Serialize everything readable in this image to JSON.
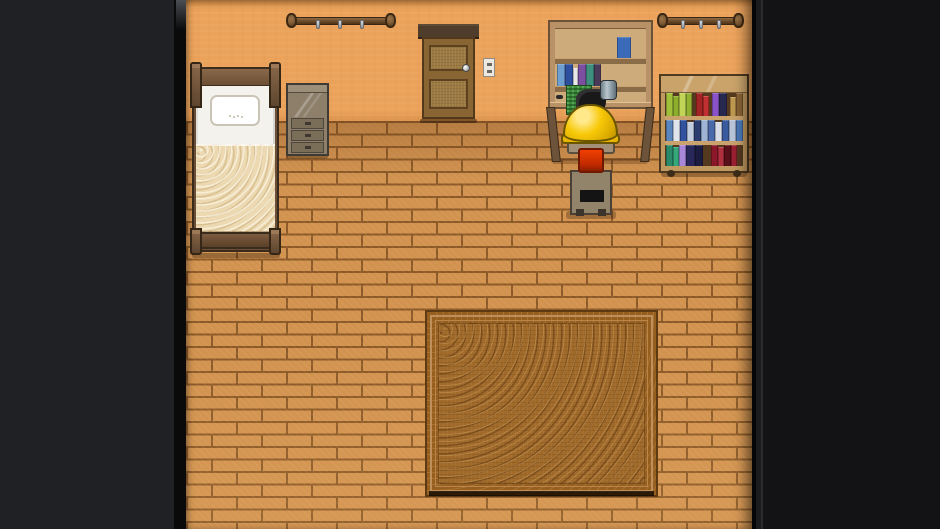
{
  "app": {
    "type": "game-screenshot",
    "scene_name": "pixel-art bedroom interior (top-down RPG room)"
  },
  "scene": {
    "objects": [
      {
        "name": "left-wall-rack"
      },
      {
        "name": "right-wall-rack"
      },
      {
        "name": "wooden-door"
      },
      {
        "name": "light-switch"
      },
      {
        "name": "bed-with-pillow-and-blanket"
      },
      {
        "name": "nightstand-dresser"
      },
      {
        "name": "workbench-desk-with-hutch"
      },
      {
        "name": "machine-with-circuit-board"
      },
      {
        "name": "character-in-yellow-hard-hat"
      },
      {
        "name": "chair"
      },
      {
        "name": "rolling-bookshelf"
      },
      {
        "name": "ornate-rug"
      }
    ]
  },
  "palette": {
    "letterbox_left": "#1f2124",
    "letterbox_divider": "#0a0a0b",
    "letterbox_right": "#131315",
    "wall": "#eba25a",
    "floor_brick": "#d29350",
    "floor_mortar": "#8c5a28",
    "rug_base": "#9c6526",
    "rug_border_line": "#c0905a",
    "bed_frame": "#79593c",
    "bed_sheet": "#f4f2ec",
    "bed_blanket": "#ecd9b2",
    "dresser": "#8d7f6a",
    "door": "#8a6534",
    "desk": "#ceab7a",
    "helmet_yellow": "#f7c908",
    "jacket_patch_orange": "#e83600",
    "chair": "#92836b",
    "bookshelf": "#bf9960",
    "circuit_green": "#3c8a3c"
  },
  "books": {
    "shelf_row1": [
      {
        "c": "#a2bf3a",
        "w": 7
      },
      {
        "c": "#8dae2c",
        "w": 6,
        "h": 20
      },
      {
        "c": "#c1d455",
        "w": 7
      },
      {
        "c": "#93b232",
        "w": 6
      },
      {
        "c": "#a32424",
        "w": 7,
        "ml": 4
      },
      {
        "c": "#c03030",
        "w": 6,
        "h": 20
      },
      {
        "c": "#8a52c8",
        "w": 7,
        "ml": 3
      },
      {
        "c": "#27284e",
        "w": 8
      },
      {
        "c": "#bf9a50",
        "w": 6,
        "ml": 3,
        "h": 19
      },
      {
        "c": "#8a6434",
        "w": 7
      }
    ],
    "shelf_row2": [
      {
        "c": "#5a86c0",
        "w": 7
      },
      {
        "c": "#dfe4ec",
        "w": 7
      },
      {
        "c": "#31529e",
        "w": 7
      },
      {
        "c": "#c3cde0",
        "w": 7,
        "h": 19
      },
      {
        "c": "#2b3c6e",
        "w": 7
      },
      {
        "c": "#9fb4d4",
        "w": 7
      },
      {
        "c": "#4a6aaa",
        "w": 7
      },
      {
        "c": "#d8dde8",
        "w": 7,
        "h": 19
      },
      {
        "c": "#3a5a9e",
        "w": 7
      },
      {
        "c": "#b8c4da",
        "w": 7
      },
      {
        "c": "#4a78b8",
        "w": 7
      }
    ],
    "shelf_row3": [
      {
        "c": "#2a8a6a",
        "w": 7
      },
      {
        "c": "#35a87a",
        "w": 6,
        "h": 19
      },
      {
        "c": "#a886d8",
        "w": 7
      },
      {
        "c": "#28285a",
        "w": 9
      },
      {
        "c": "#1c1c40",
        "w": 8
      },
      {
        "c": "#8a1828",
        "w": 7,
        "ml": 8
      },
      {
        "c": "#b03040",
        "w": 6,
        "h": 19
      },
      {
        "c": "#5a1018",
        "w": 7
      },
      {
        "c": "#9a2030",
        "w": 6
      }
    ],
    "desk_shelf": [
      {
        "c": "#6f9fd0",
        "w": 8
      },
      {
        "c": "#2e4e9e",
        "w": 8
      },
      {
        "c": "#e8e8e8",
        "w": 5,
        "h": 18
      },
      {
        "c": "#7c4fa0",
        "w": 8
      },
      {
        "c": "#3f8f7f",
        "w": 8
      },
      {
        "c": "#4a3a5a",
        "w": 7
      }
    ],
    "desk_top_shelf": [
      {
        "c": "#3a6ab8",
        "w": 14
      }
    ]
  }
}
